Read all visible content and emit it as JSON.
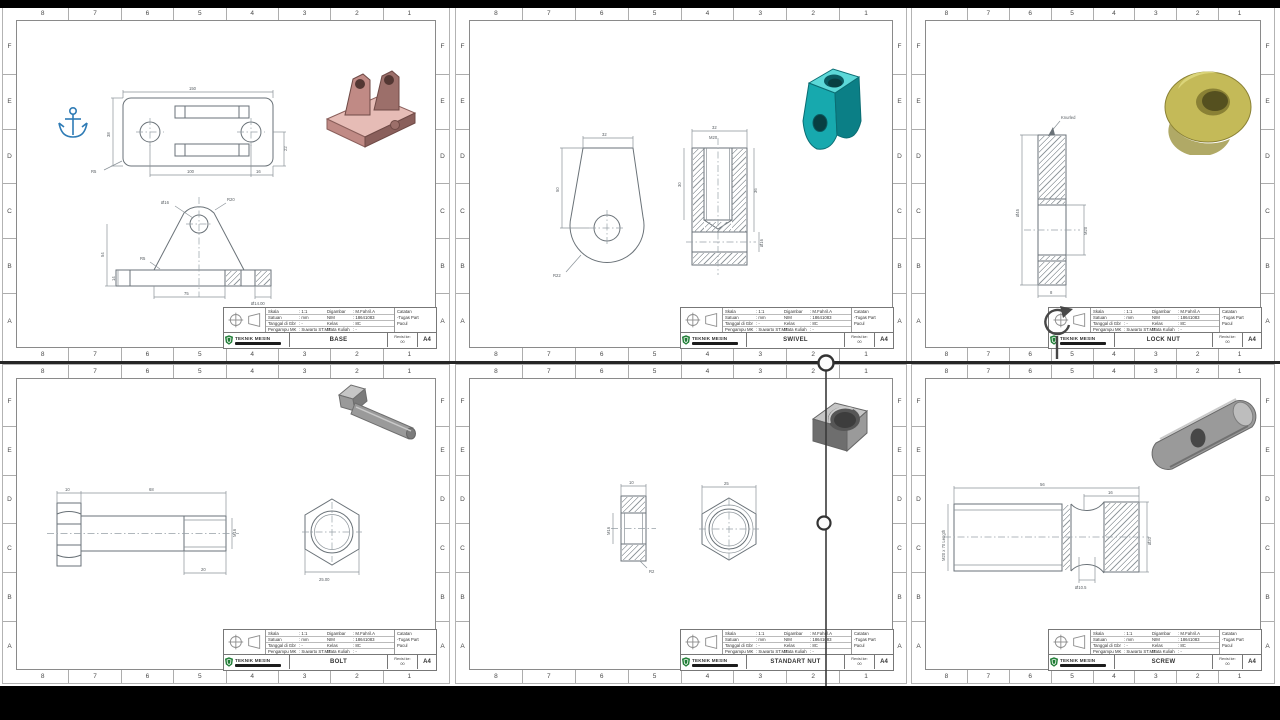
{
  "stage": {
    "width": 1280,
    "height": 720,
    "bar_color": "#000000",
    "page_color": "#ffffff",
    "divider_color": "#262626"
  },
  "zones": {
    "numbers": [
      "8",
      "7",
      "6",
      "5",
      "4",
      "3",
      "2",
      "1"
    ],
    "letters": [
      "F",
      "E",
      "D",
      "C",
      "B",
      "A"
    ]
  },
  "title_block": {
    "skala_label": "Skala",
    "skala_value": ": 1:1",
    "satuan_label": "Satuan",
    "satuan_value": ": mm",
    "tanggal_label": "Tanggal di Gbr",
    "tanggal_value": ": -",
    "pengampu_label": "Pengampu MK",
    "pengampu_value": ": Suwarto ST.MT",
    "digambar_label": "Digambar",
    "digambar_value": ": M.Fahril.A",
    "nim_label": "NIM",
    "nim_value": ": 18641083",
    "kelas_label": "Kelas",
    "kelas_value": ": 8C",
    "mk_label": "Mata Kuliah",
    "mk_value": ": -",
    "catatan_label": "Catatan",
    "catatan_line2": "-Tugas Part",
    "catatan_line3": "Pacul",
    "dept": "TEKNIK MESIN",
    "revisi_label": "Revisi ke:",
    "revisi_value": "00",
    "paper_size": "A4"
  },
  "colors": {
    "base_part": "#c08a85",
    "base_light": "#e6bcb6",
    "base_dark": "#8a5f5b",
    "swivel": "#17a9ae",
    "swivel_light": "#5cd8d8",
    "swivel_dark": "#0b7f86",
    "lock_nut": "#c4ba58",
    "lock_nut_dark": "#55501f",
    "steel": "#9a9a9a",
    "steel_light": "#c6c6c6",
    "steel_dark": "#6e6e6e",
    "anchor_blue": "#2e7bb5"
  },
  "icons": {
    "anchor": "anchor-icon",
    "rotate": "rotate-view-icon",
    "handle": "selection-handle"
  },
  "sheets": [
    {
      "title": "BASE",
      "dims": {
        "d1": "150",
        "d2": "38",
        "d3": "100",
        "d4": "16",
        "d5": "22",
        "d6": "R5",
        "d7": "Ø16",
        "d8": "R20",
        "d9": "R5",
        "d10": "54",
        "d11": "14",
        "d12": "75",
        "d13": "Ø14.00"
      }
    },
    {
      "title": "SWIVEL",
      "dims": {
        "d1": "32",
        "d2": "50",
        "d3": "R22",
        "d4": "32",
        "d5": "M20",
        "d6": "30",
        "d7": "36",
        "d8": "Ø16"
      }
    },
    {
      "title": "LOCK NUT",
      "dims": {
        "d1": "Knurled",
        "d2": "Ø45",
        "d3": "M20",
        "d4": "8"
      }
    },
    {
      "title": "BOLT",
      "dims": {
        "d1": "10",
        "d2": "68",
        "d3": "M16",
        "d4": "20",
        "d5": "25.00"
      }
    },
    {
      "title": "STANDART NUT",
      "dims": {
        "d1": "10",
        "d2": "M16",
        "d3": "R2",
        "d4": "25"
      }
    },
    {
      "title": "SCREW",
      "dims": {
        "d1": "56",
        "d2": "16",
        "d3": "M20 x 70 Length",
        "d4": "Ø10.5",
        "d5": "Ø20"
      }
    }
  ]
}
